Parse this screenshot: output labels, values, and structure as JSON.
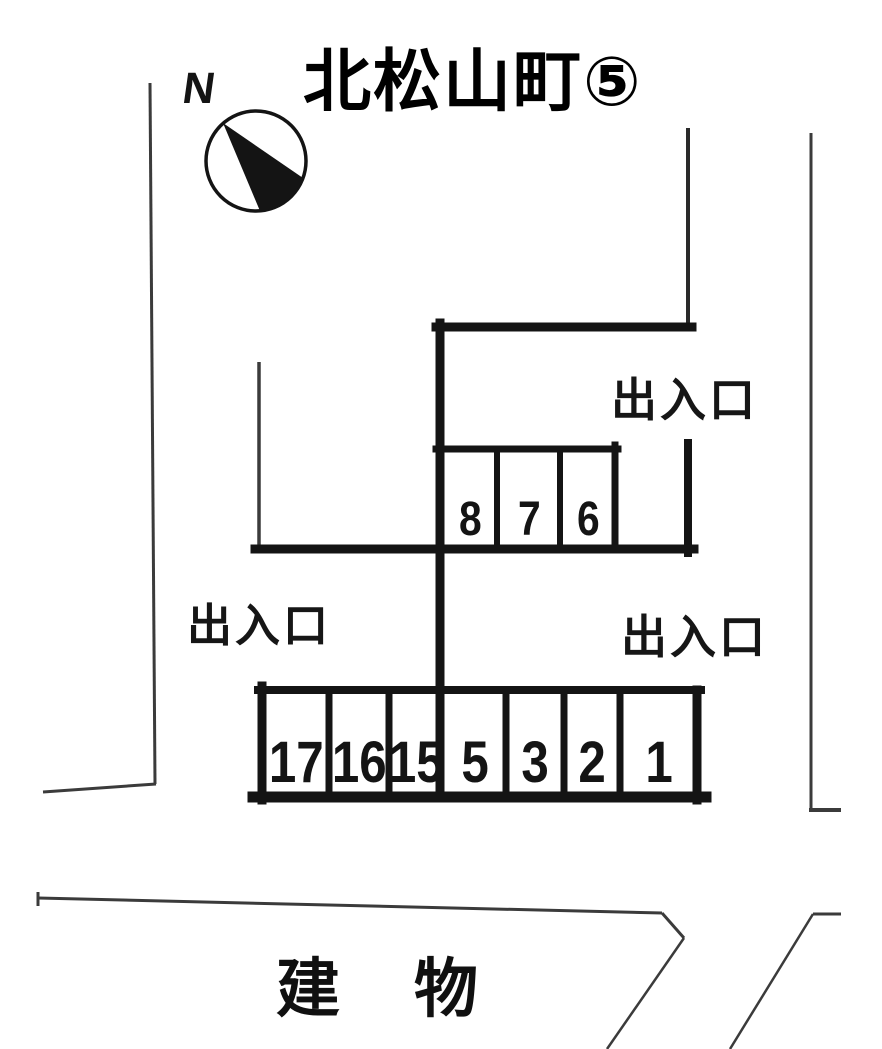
{
  "title": "北松山町⑤",
  "compass": {
    "label": "N"
  },
  "labels": {
    "entrance_top_right": "出入口",
    "entrance_left": "出入口",
    "entrance_bottom_right": "出入口",
    "building": "建物"
  },
  "parking": {
    "row_upper": {
      "spaces": [
        "8",
        "7",
        "6"
      ]
    },
    "row_lower": {
      "spaces": [
        "17",
        "16",
        "15",
        "5",
        "3",
        "2",
        "1"
      ]
    }
  },
  "colors": {
    "ink_thick": "#141414",
    "ink_thin": "#3b3b3b",
    "background": "#ffffff"
  }
}
